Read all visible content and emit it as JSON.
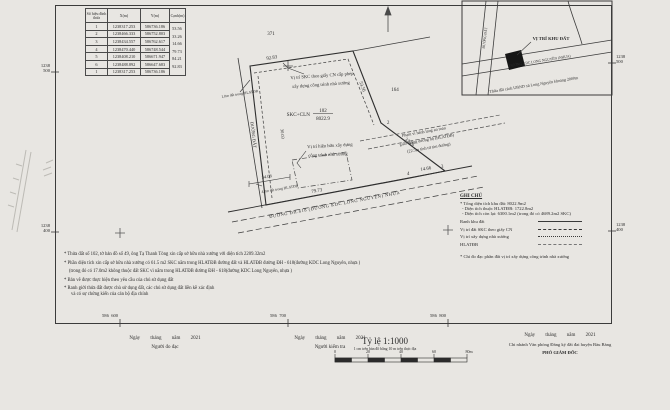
{
  "frame": {
    "grid_left_top": {
      "a": "1238",
      "b": "500"
    },
    "grid_left_bottom": {
      "a": "1238",
      "b": "400"
    },
    "grid_right_top": {
      "a": "1238",
      "b": "500"
    },
    "grid_right_bottom": {
      "a": "1238",
      "b": "400"
    },
    "grid_bottom": [
      {
        "a": "586",
        "b": "600"
      },
      {
        "a": "586",
        "b": "700"
      },
      {
        "a": "586",
        "b": "800"
      }
    ]
  },
  "coord_table": {
    "headers": {
      "id": "Số hiệu đỉnh thửa",
      "x": "X(m)",
      "y": "Y(m)",
      "edge": "Cạnh(m)"
    },
    "rows": [
      {
        "id": "1",
        "x": "1238317.253",
        "y": "586736.186"
      },
      {
        "id": "2",
        "x": "1238466.333",
        "y": "586752.803"
      },
      {
        "id": "3",
        "x": "1238434.557",
        "y": "586762.617"
      },
      {
        "id": "4",
        "x": "1238470.440",
        "y": "586748.544"
      },
      {
        "id": "5",
        "x": "1238408.210",
        "y": "586671.947"
      },
      {
        "id": "6",
        "x": "1238488.892",
        "y": "586647.683"
      },
      {
        "id": "1",
        "x": "1238317.253",
        "y": "586736.186"
      }
    ],
    "edges": [
      "53.56",
      "33.26",
      "14.66",
      "79.73",
      "84.21",
      "92.83"
    ]
  },
  "parcel": {
    "land_type": "SKC+CLN",
    "parcel_number": "102",
    "area": "8022.9",
    "neighbor_top": "371",
    "neighbor_right": "164",
    "vertex_2": "2",
    "vertex_3": "3",
    "vertex_4": "4",
    "dim_top": "92.83",
    "dim_right_upper": "53.56",
    "dim_right_lower": "33.26",
    "dim_bottom_right": "14.66",
    "dim_bottom": "79.73",
    "dim_inner_bottom": "34.08",
    "dim_inner_left": "30.03",
    "strip_note_top": "1,0m đất trong HLATĐB",
    "strip_note_bottom": "4,0m đất trong HLATĐB",
    "skc_note_1": "Vị trí SKC theo giấy CN cấp phép",
    "skc_note_2": "xây dựng công trình nhà xưởng",
    "existing_note_1": "Vị trí hiện hữu xây dựng",
    "existing_note_2": "công trình nhà xưởng",
    "hlatdb_note_1": "Phạm vi hành lang an toàn",
    "hlatdb_note_2": "giao thông đường bộ (HLATĐB)",
    "hlatdb_note_3": "(22.5m tính từ tim đường)",
    "road_bottom": "ĐƯỜNG ĐH.618 (ĐƯỜNG KDC LONG NGUYÊN) NHỰA",
    "road_left": "ĐƯỜNG ĐẤT"
  },
  "minimap": {
    "title": "VỊ TRÍ KHU ĐẤT",
    "road_diag": "ĐƯỜNG KDC LONG NGUYÊN (NHỰA)",
    "road_vert": "ĐƯỜNG ĐẤT",
    "caption": "Thửa đất cách UBND xã Long Nguyên khoảng 2000m"
  },
  "legend": {
    "title": "GHI CHÚ",
    "line1": "* Tổng diện tích khu đất: 8022.9m2",
    "line2": "- Diện tích thuộc HLATĐB: 1722.8m2",
    "line3": "- Diện tích còn lại: 6300.1m2 (trong đó có 4689.2m2 SKC)",
    "items": [
      {
        "label": "Ranh khu đất"
      },
      {
        "label": "Vị trí đất SKC theo giấy CN"
      },
      {
        "label": "Vị trí xây dựng nhà xưởng"
      },
      {
        "label": "HLATĐB"
      }
    ],
    "footnote": "* Chỉ đo đạc phần đất vị trí xây dựng công trình nhà xưởng"
  },
  "notes": {
    "n1": "* Thửa đất số 102, tờ bản đồ số 49, ông Tạ Thanh Tòng xin cấp sở hữu nhà xưởng với diện tích 2209.32m2",
    "n2": "* Phần diện tích xin cấp sở hữu nhà xưởng có 61.5 m2 SKC nằm trong HLATĐB đường đất và HLATĐB đường ĐH - 618(đường KDC Long Nguyên, nhựa )",
    "n3": "(trong đó có 17.0m2 không thuộc đất SKC vì nằm trong HLATĐB đường ĐH - 618(đường KDC Long Nguyên, nhựa )",
    "n4": "* Bản vẽ được thực hiện theo yêu cầu của chủ sử dụng đất",
    "n5": "* Ranh giới thửa đất được chủ sử dụng đất, các chủ sử dụng đất liền kề xác định",
    "n6": "và có sự chứng kiến của cán bộ địa chính"
  },
  "footer": {
    "left": {
      "date": "Ngày tháng năm 2021",
      "role": "Người đo đạc"
    },
    "center": {
      "date": "Ngày tháng năm 2021",
      "role": "Người kiểm tra"
    },
    "right": {
      "date": "Ngày tháng năm 2021",
      "org": "Chi nhánh Văn phòng Đăng ký đất đai huyện Bàu Bàng",
      "role": "PHÓ GIÁM ĐỐC"
    },
    "scale": {
      "title": "Tỷ lệ 1:1000",
      "subtitle": "1 cm trên bản đồ bằng 10 m trên thực địa",
      "ticks": [
        "0",
        "20",
        "40",
        "60",
        "80m"
      ]
    }
  }
}
